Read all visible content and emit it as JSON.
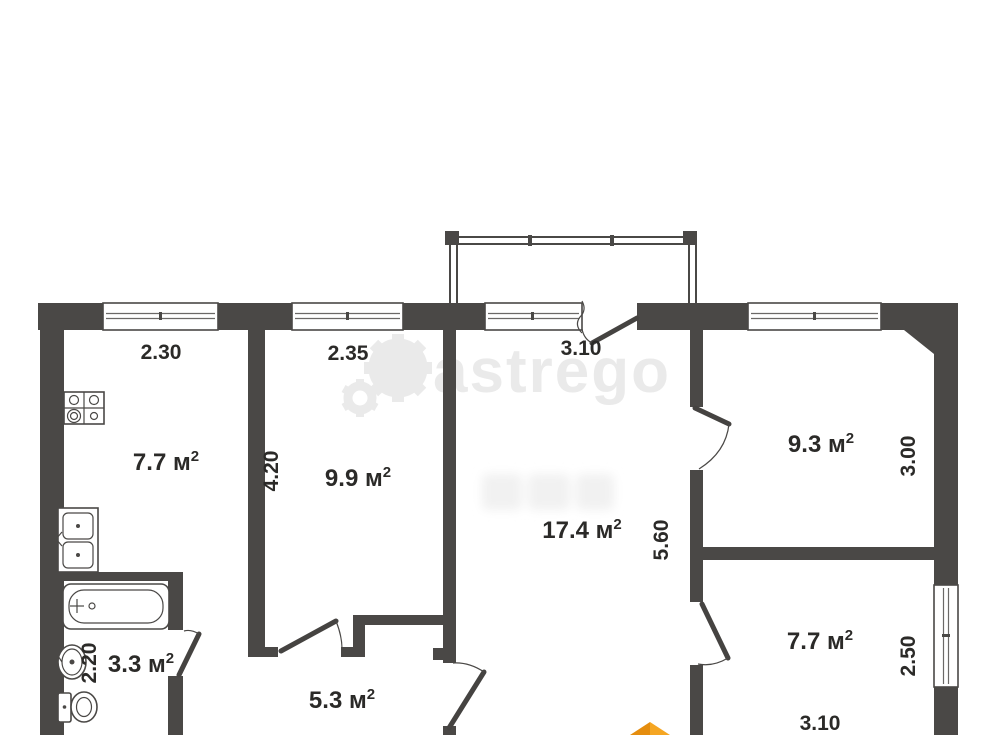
{
  "watermark": {
    "brand": "astrego"
  },
  "rooms": {
    "kitchen": {
      "area": "7.7 м",
      "sup": "2"
    },
    "room2": {
      "area": "9.9 м",
      "sup": "2"
    },
    "living": {
      "area": "17.4 м",
      "sup": "2"
    },
    "room3": {
      "area": "9.3 м",
      "sup": "2"
    },
    "room4": {
      "area": "7.7 м",
      "sup": "2"
    },
    "bathroom": {
      "area": "3.3 м",
      "sup": "2"
    },
    "hallway": {
      "area": "5.3 м",
      "sup": "2"
    }
  },
  "dims": {
    "kitchen_width": "2.30",
    "room2_width": "2.35",
    "balcony_width": "3.10",
    "room2_height": "4.20",
    "hall_height": "5.60",
    "room3_height": "3.00",
    "room4_window": "2.50",
    "bath_height": "2.20",
    "room4_width": "3.10"
  },
  "colors": {
    "wall": "#4a4846",
    "text": "#2b2a28",
    "watermark": "#eaeaea",
    "logo_orange_dark": "#e58d0e",
    "logo_orange_light": "#f5a623"
  }
}
